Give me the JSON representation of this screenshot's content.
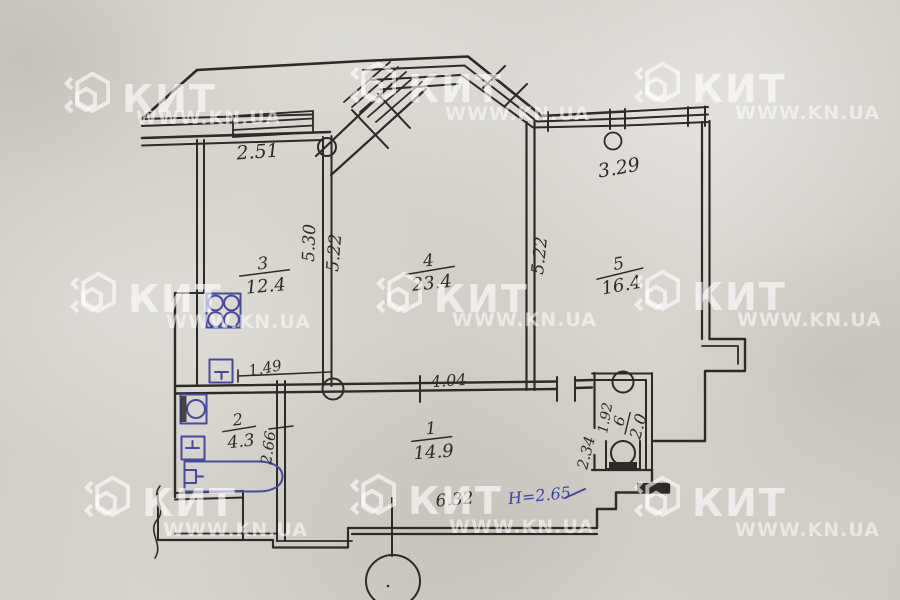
{
  "watermark": {
    "brand": "КИТ",
    "site": "WWW.KN.UA"
  },
  "plan": {
    "rooms": [
      {
        "id": "room-3",
        "number": "3",
        "area": "12.4"
      },
      {
        "id": "room-4",
        "number": "4",
        "area": "23.4"
      },
      {
        "id": "room-5",
        "number": "5",
        "area": "16.4"
      },
      {
        "id": "room-2",
        "number": "2",
        "area": "4.3"
      },
      {
        "id": "room-1",
        "number": "1",
        "area": "14.9"
      },
      {
        "id": "room-6",
        "number": "6",
        "area": "2.0"
      }
    ],
    "dimensions": {
      "balcony_left": "2.51",
      "balcony_right": "3.29",
      "room3_depth": "5.30",
      "room4_depth": "5.22",
      "room5_depth": "5.22",
      "kitchen_opening": "1.49",
      "room4_width": "4.04",
      "bathroom_depth": "2.66",
      "hall_width": "6.32",
      "ceiling_height": "Н=2.65",
      "wc_depth": "1.92",
      "hall_side": "2.34"
    },
    "colors": {
      "ink": "#2d2a27",
      "blue_ink": "#4649a0",
      "paper": "#d3d0c9"
    }
  }
}
